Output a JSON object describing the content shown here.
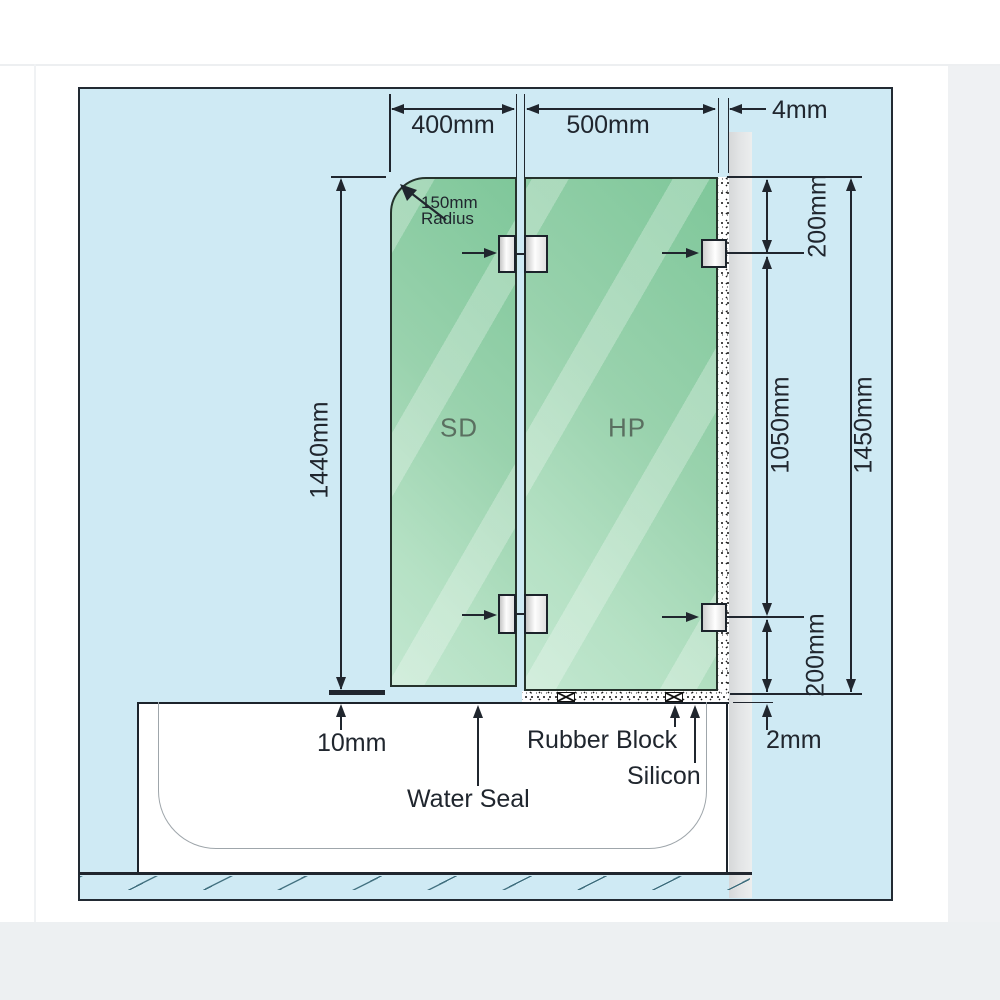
{
  "colors": {
    "ink": "#20262e",
    "canvas-bg": "#cfeaf4",
    "glass-dark": "#7fc79a",
    "glass-light": "#c2e7d0",
    "wall-gray": "#dfe1e2",
    "panel-label": "#5a6f60"
  },
  "dims": {
    "door_width": "400mm",
    "fixed_width": "500mm",
    "wall_gap": "4mm",
    "door_height": "1440mm",
    "top_offset": "200mm",
    "bracket_span": "1050mm",
    "fixed_height": "1450mm",
    "bottom_offset": "200mm",
    "base_gap": "2mm",
    "door_lift": "10mm"
  },
  "corner_note": {
    "line1": "150mm",
    "line2": "Radius"
  },
  "panels": {
    "door": "SD",
    "fixed": "HP"
  },
  "callouts": {
    "water_seal": "Water Seal",
    "rubber_block": "Rubber Block",
    "silicon": "Silicon"
  }
}
